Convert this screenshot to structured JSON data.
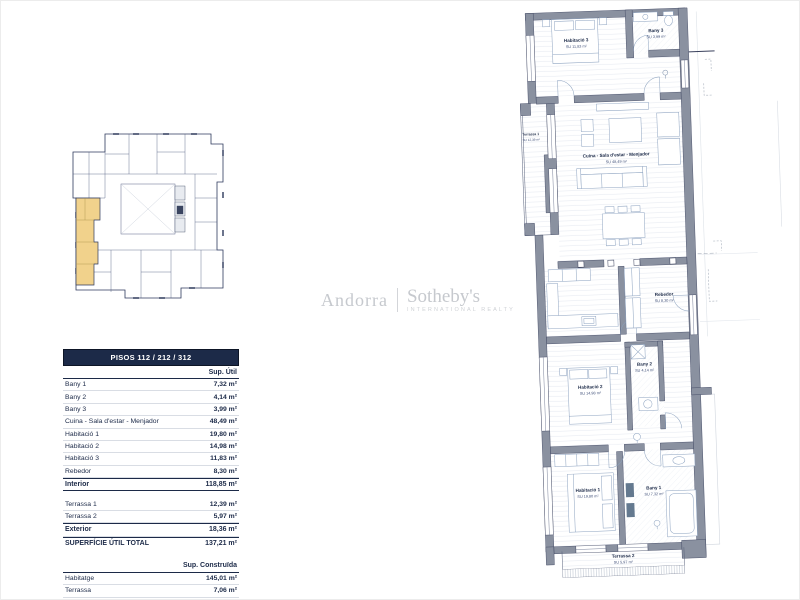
{
  "logo": {
    "brand": "Andorra",
    "name": "Sotheby's",
    "tagline": "INTERNATIONAL REALTY",
    "color": "#c6c9ce"
  },
  "overview_plan": {
    "highlight_color": "#f1d28c"
  },
  "surface_table": {
    "title": "PISOS 112 / 212 / 312",
    "header_bg": "#1c2a48",
    "text_color": "#1c2a48",
    "useful": {
      "column_header": "Sup. Útil",
      "rows": [
        {
          "label": "Bany 1",
          "value": "7,32 m²"
        },
        {
          "label": "Bany 2",
          "value": "4,14 m²"
        },
        {
          "label": "Bany 3",
          "value": "3,99 m²"
        },
        {
          "label": "Cuina - Sala d'estar - Menjador",
          "value": "48,49 m²"
        },
        {
          "label": "Habitació 1",
          "value": "19,80 m²"
        },
        {
          "label": "Habitació 2",
          "value": "14,98 m²"
        },
        {
          "label": "Habitació 3",
          "value": "11,83 m²"
        },
        {
          "label": "Rebedor",
          "value": "8,30 m²"
        }
      ],
      "interior": {
        "label": "Interior",
        "value": "118,85 m²"
      },
      "terraces": [
        {
          "label": "Terrassa 1",
          "value": "12,39 m²"
        },
        {
          "label": "Terrassa 2",
          "value": "5,97 m²"
        }
      ],
      "exterior": {
        "label": "Exterior",
        "value": "18,36 m²"
      },
      "total": {
        "label": "SUPERFÍCIE ÚTIL TOTAL",
        "value": "137,21 m²"
      }
    },
    "built": {
      "column_header": "Sup. Construïda",
      "rows": [
        {
          "label": "Habitatge",
          "value": "145,01 m²"
        },
        {
          "label": "Terrassa",
          "value": "7,06 m²"
        },
        {
          "label": "Terrassa",
          "value": "13,57 m²"
        }
      ],
      "total": {
        "label": "SUPERFÍCIE CONSTRUÏDA TOTAL",
        "value": "165,64 m²"
      }
    }
  },
  "floor_plan": {
    "rooms": {
      "habitacio3": {
        "name": "Habitació 3",
        "area": "SU 11,83 m²"
      },
      "bany3": {
        "name": "Bany 3",
        "area": "SU 3,99 m²"
      },
      "terrassa1": {
        "name": "Terrassa 1",
        "area": "SU 12,39 m²"
      },
      "cuina_sala": {
        "name": "Cuina - Sala d'estar - Menjador",
        "area": "SU 48,49 m²"
      },
      "rebedor": {
        "name": "Rebedor",
        "area": "SU 8,30 m²"
      },
      "habitacio2": {
        "name": "Habitació 2",
        "area": "SU 14,98 m²"
      },
      "bany2": {
        "name": "Bany 2",
        "area": "SU 4,14 m²"
      },
      "habitacio1": {
        "name": "Habitació 1",
        "area": "SU 19,80 m²"
      },
      "bany1": {
        "name": "Bany 1",
        "area": "SU 7,32 m²"
      },
      "terrassa2": {
        "name": "Terrassa 2",
        "area": "SU 5,97 m²"
      }
    },
    "colors": {
      "wall": "#8a91a0",
      "line": "#39405c",
      "furniture": "#8ba1bf",
      "floor_line": "#e3e8f0"
    }
  }
}
